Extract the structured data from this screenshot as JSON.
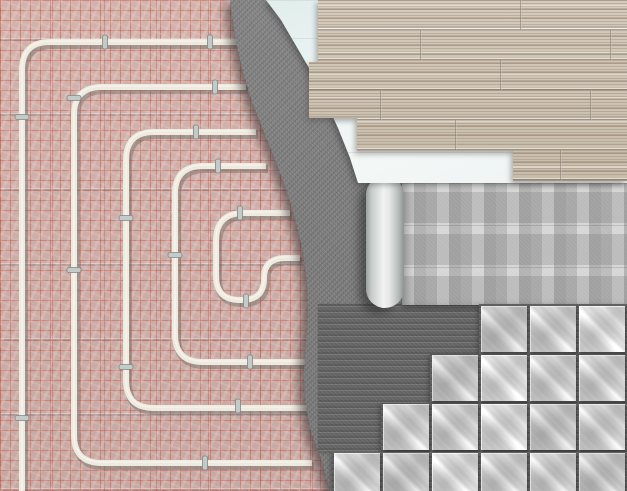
{
  "scene": {
    "subject": "underfloor-heating-installation-layers-top-view",
    "description": "Cutaway illustration of floor heating layers: heating pipe circuit fixed on a pink insulation mat with red marking grid, covered by concrete screed, then underlays and finish floor coverings (laminate planks, rolled underlayment, ceramic tiles on ribbed adhesive)",
    "regions": [
      {
        "name": "insulation-mat",
        "appearance": "pink foil with red marking grid",
        "base_color": "#cdada7",
        "grid_color": "#c85a4c",
        "seam_color": "#78706e"
      },
      {
        "name": "heating-pipes",
        "pipe_color": "#edeadf",
        "shadow_color": "#6f6a63",
        "loop_count": 5,
        "clip_count": 17,
        "clip_color": "#c3cac8"
      },
      {
        "name": "concrete-screed",
        "base_color": "#7b7b7b",
        "edge": "wavy"
      },
      {
        "name": "underlay-board",
        "base_color": "#e7f1f0"
      },
      {
        "name": "laminate-flooring",
        "base_color": "#cdc3b4",
        "plank_row_height_px": 30,
        "edge": "stepped"
      },
      {
        "name": "underlayment-roll",
        "sheet_color": "#bcbcbc",
        "bar_color": "#d6d6d6",
        "roll_color": "#f1f3f2"
      },
      {
        "name": "tile-adhesive",
        "base_color": "#646464",
        "texture": "ribbed"
      },
      {
        "name": "ceramic-tiles",
        "base_color": "#c6c6c6",
        "vein_color": "#ffffff",
        "tile_size_px": 46,
        "tile_rows": 4,
        "layout": "diagonal-staircase"
      }
    ]
  }
}
